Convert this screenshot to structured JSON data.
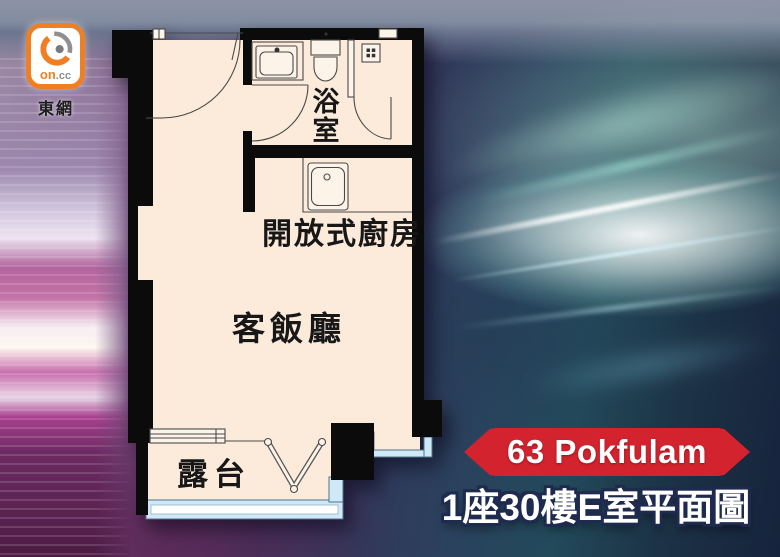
{
  "site": {
    "logo_on": "on",
    "logo_cc": ".cc",
    "name": "東網"
  },
  "floorplan": {
    "rooms": [
      {
        "name": "bathroom",
        "label": "浴室",
        "chars": [
          "浴",
          "室"
        ]
      },
      {
        "name": "open-kitchen",
        "label": "開放式廚房"
      },
      {
        "name": "living-dining",
        "label": "客飯廳"
      },
      {
        "name": "balcony",
        "label": "露台"
      }
    ],
    "colors": {
      "floor": "#fcebdb",
      "wall": "#0b0b0b",
      "glass": "#cfe9f8"
    }
  },
  "caption": {
    "banner": "63 Pokfulam",
    "banner_color": "#d2232e",
    "title": "1座30樓E室平面圖"
  }
}
